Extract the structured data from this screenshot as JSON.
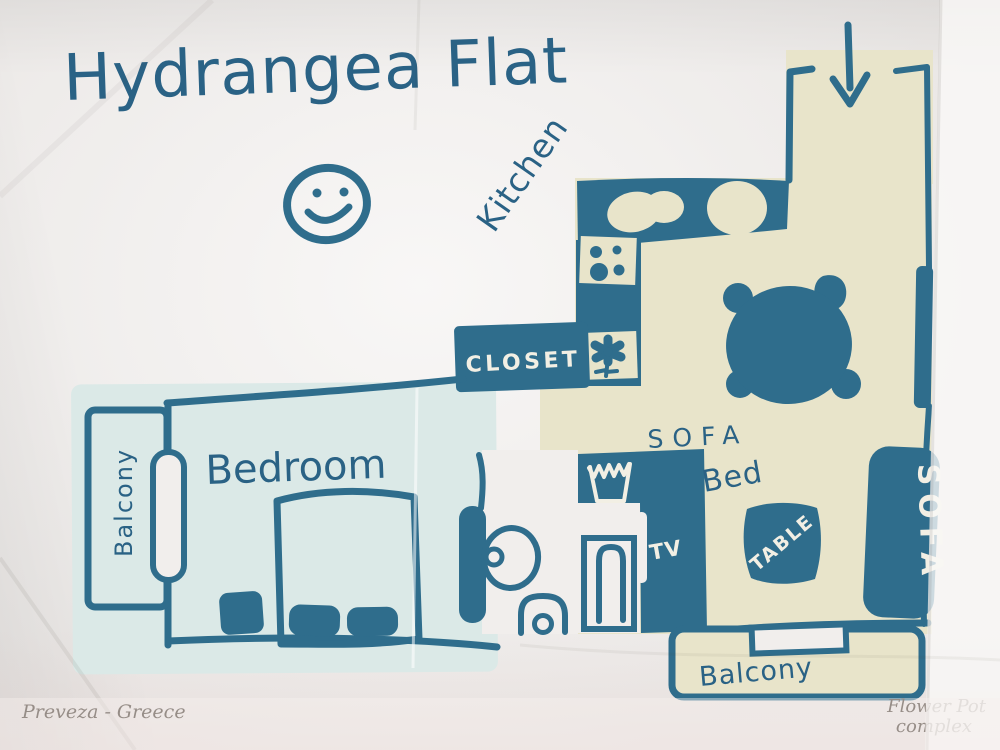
{
  "title": "Hydrangea Flat",
  "rooms": {
    "kitchen": "Kitchen",
    "closet": "CLOSET",
    "bedroom": "Bedroom",
    "balcony_left": "Balcony",
    "balcony_bottom": "Balcony"
  },
  "furniture": {
    "sofa_bed_line1": "SOFA",
    "sofa_bed_line2": "Bed",
    "tv": "TV",
    "coffee_table": "TABLE",
    "sofa": "SOFA"
  },
  "footer": {
    "location": "Preveza - Greece",
    "complex_line1": "Flower Pot",
    "complex_line2": "complex"
  },
  "icons": {
    "smiley": "smiley-face-icon",
    "entrance_arrow": "down-arrow-icon",
    "plant": "flower-icon",
    "laundry": "laundry-basket-icon",
    "stove": "stove-burners-icon",
    "kitchen_sink": "kitchen-sink-icon",
    "dining_table": "dining-table-icon",
    "toilet": "toilet-icon",
    "washbasin": "washbasin-icon",
    "bed": "bed-icon",
    "door": "door-icon"
  },
  "colors": {
    "ink": "#2f6d8c",
    "handwriting": "#2a6285",
    "beige": "#e8e4ca",
    "bedroom_blue": "#dbe9e7",
    "paper": "#f1eeec",
    "label": "#f2efe4",
    "footer_ink": "#473d34"
  }
}
